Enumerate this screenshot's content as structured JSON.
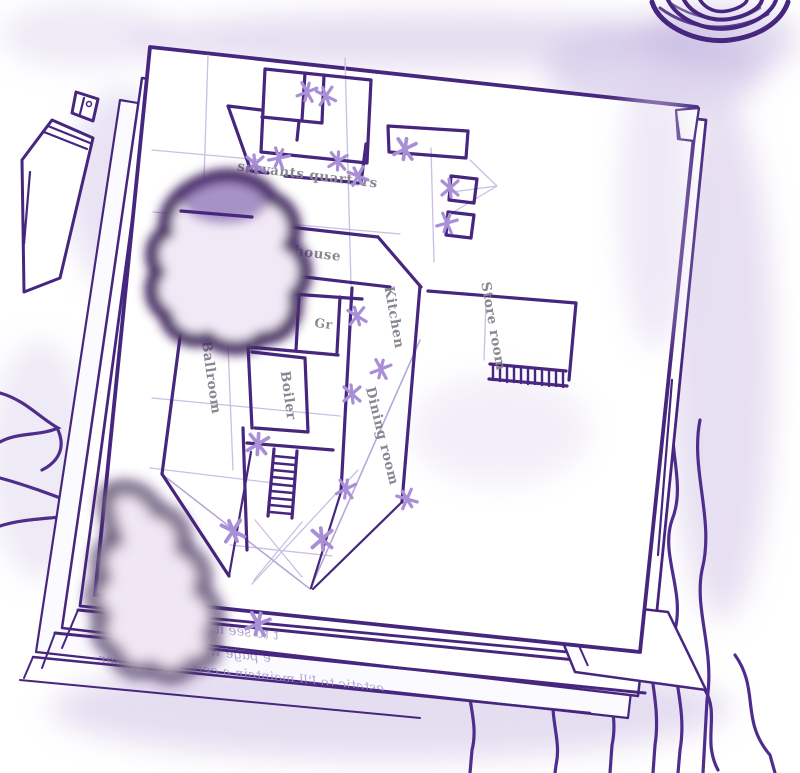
{
  "scene": {
    "description": "Hand-drawn purple ink sketch: a floor plan on the top sheet of a stack of papers, with a pen at left, an ink pot at top right, ink blots on the page and cloth squiggles around",
    "ink_color": "#46267e",
    "marker_color": "#a98fd6",
    "guide_color": "#c9bfe4",
    "label_color": "#8b8792",
    "blot_edge_color": "#40215f",
    "blot_center_color": "#f2e9f6",
    "shadow_color": "#cfc2e6",
    "paper_color": "#ffffff"
  },
  "floor_plan": {
    "rooms": [
      {
        "id": "servants-quarters",
        "label": "servants quarters"
      },
      {
        "id": "house",
        "label": "house"
      },
      {
        "id": "gr-left",
        "label": "Gr"
      },
      {
        "id": "gr-right",
        "label": "Gr"
      },
      {
        "id": "kitchen",
        "label": "Kitchen"
      },
      {
        "id": "store-room",
        "label": "Store room"
      },
      {
        "id": "ballroom",
        "label": "Ballroom"
      },
      {
        "id": "boiler",
        "label": "Boiler"
      },
      {
        "id": "dining-room",
        "label": "Dining room"
      }
    ],
    "marker_glyph": "x",
    "marker_count": 18
  },
  "back_page_text": {
    "mirrored": true,
    "lines": [
      "t to see it. Still the",
      "e page was strickly",
      "estatic to I'll maintain a certain composer."
    ]
  }
}
